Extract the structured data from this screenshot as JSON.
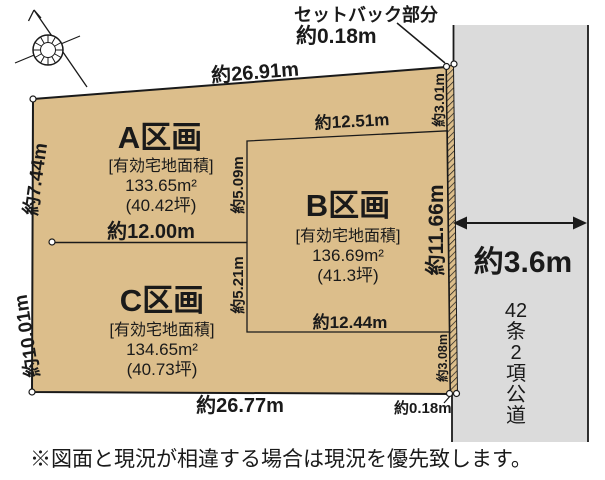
{
  "setback_callout": {
    "title": "セットバック部分",
    "value": "約0.18m"
  },
  "parcels": [
    {
      "name": "A区画",
      "area_label": "[有効宅地面積]",
      "area": "133.65m²",
      "tsubo": "(40.42坪)"
    },
    {
      "name": "B区画",
      "area_label": "[有効宅地面積]",
      "area": "136.69m²",
      "tsubo": "(41.3坪)"
    },
    {
      "name": "C区画",
      "area_label": "[有効宅地面積]",
      "area": "134.65m²",
      "tsubo": "(40.73坪)"
    }
  ],
  "dimensions": {
    "top_edge": "約26.91m",
    "left_upper_edge": "約7.44m",
    "left_lower_edge": "約10.01m",
    "bottom_edge": "約26.77m",
    "a_c_boundary": "約12.00m",
    "b_top": "約12.51m",
    "b_bottom": "約12.44m",
    "b_left_upper": "約5.09m",
    "b_left_lower": "約5.21m",
    "right_upper": "約3.01m",
    "right_middle": "約11.66m",
    "right_lower": "約3.08m",
    "setback_bottom": "約0.18m"
  },
  "road": {
    "width": "約3.6m",
    "name": "42条2項公道",
    "name_chars": [
      "42",
      "条",
      "2",
      "項",
      "公",
      "道"
    ]
  },
  "footnote": "※図面と現況が相違する場合は現況を優先致します。",
  "icons": {
    "compass": "north-arrow-compass"
  },
  "colors": {
    "parcel_fill": "#dcbe8b",
    "road_fill": "#dbdbdb",
    "line": "#1a1a1a"
  }
}
